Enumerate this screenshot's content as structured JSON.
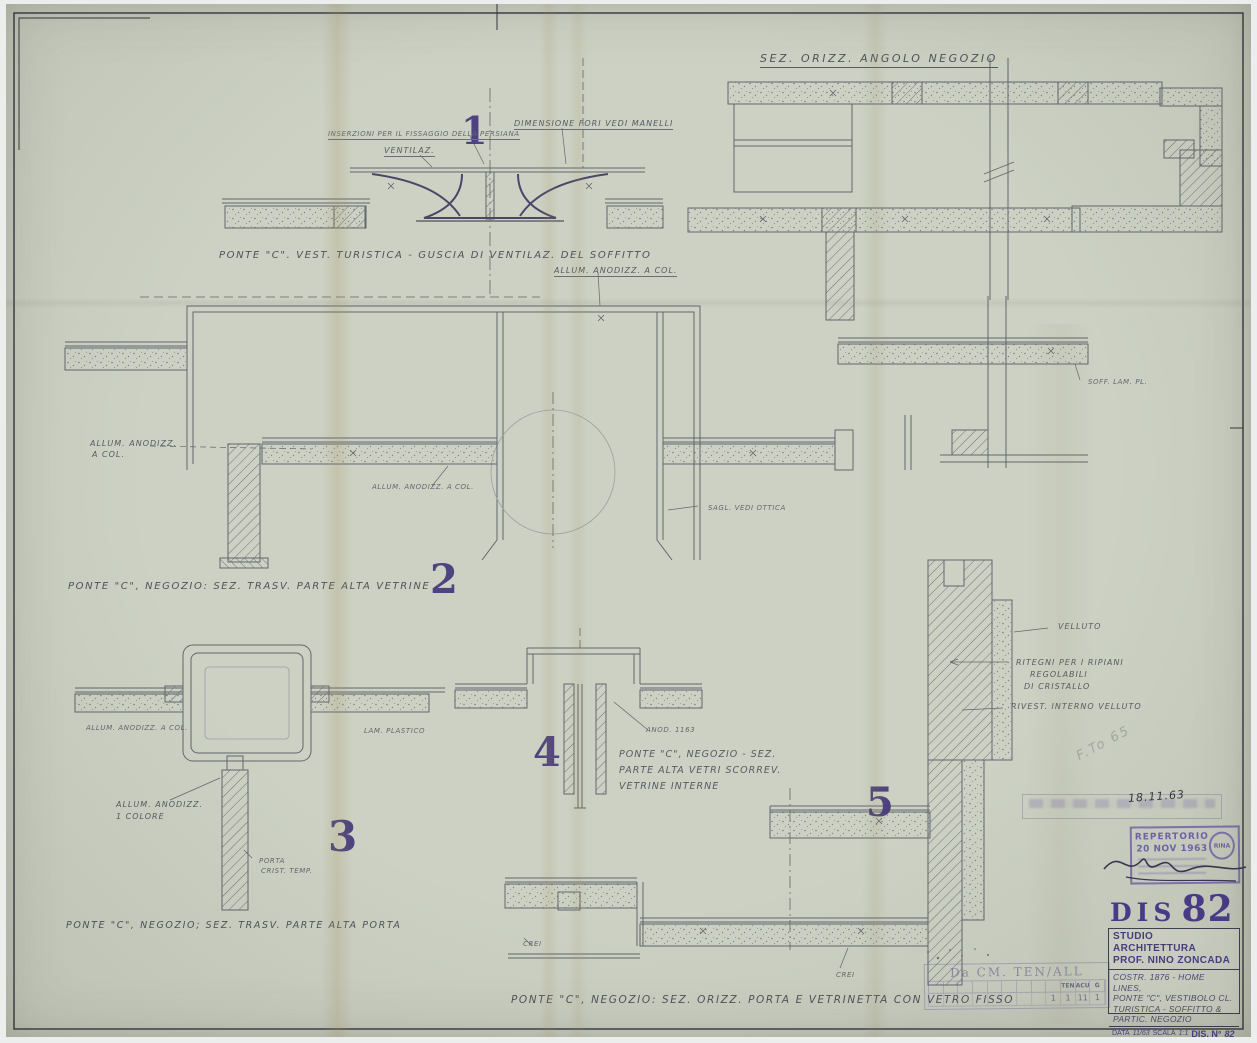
{
  "plan": {
    "title": "SEZ. ORIZZ. ANGOLO NEGOZIO"
  },
  "details": {
    "d1": {
      "number": "1",
      "label_fissaggio": "INSERZIONI PER IL FISSAGGIO DELLA PERSIANA",
      "label_ventilaz": "VENTILAZ.",
      "label_dimensione": "DIMENSIONE FORI VEDI MANELLI",
      "caption": "PONTE \"C\". VEST. TURISTICA -  GUSCIA DI VENTILAZ. DEL SOFFITTO"
    },
    "d2": {
      "number": "2",
      "label_top": "ALLUM. ANODIZZ. A COL.",
      "label_left_1": "ALLUM. ANODIZZ.",
      "label_left_2": "A COL.",
      "label_mid": "ALLUM. ANODIZZ. A COL.",
      "label_sagoma": "SAGL. VEDI OTTICA",
      "label_soffitto": "SOFF. LAM. PL.",
      "caption": "PONTE \"C\", NEGOZIO: SEZ. TRASV. PARTE ALTA VETRINE"
    },
    "d3": {
      "number": "3",
      "label_left": "ALLUM. ANODIZZ. A COL.",
      "label_lam": "LAM. PLASTICO",
      "label_anod_1": "ALLUM. ANODIZZ.",
      "label_anod_2": "1 COLORE",
      "label_porta_1": "PORTA",
      "label_porta_2": "CRIST. TEMP.",
      "caption": "PONTE \"C\", NEGOZIO; SEZ. TRASV. PARTE ALTA PORTA"
    },
    "d4": {
      "number": "4",
      "label_anod": "ANOD. 1163",
      "caption_1": "PONTE \"C\", NEGOZIO - SEZ.",
      "caption_2": "PARTE ALTA VETRI SCORREV.",
      "caption_3": "VETRINE INTERNE"
    },
    "d5": {
      "number": "5",
      "label_velluto": "VELLUTO",
      "label_ritegni_1": "RITEGNI PER I RIPIANI",
      "label_ritegni_2": "REGOLABILI",
      "label_ritegni_3": "DI CRISTALLO",
      "label_rivest": "RIVEST. INTERNO VELLUTO",
      "label_crei_a": "CREI",
      "label_crei_b": "CREI"
    },
    "bottom_caption": "PONTE \"C\", NEGOZIO: SEZ. ORIZZ. PORTA E VETRINETTA CON VETRO FISSO"
  },
  "title_block": {
    "dis_label": "DIS",
    "dis_number": "82",
    "studio_line1": "STUDIO ARCHITETTURA",
    "studio_line2": "PROF. NINO ZONCADA",
    "desc_line1": "COSTR. 1876 - HOME LINES,",
    "desc_line2": "PONTE \"C\", VESTIBOLO CL.",
    "desc_line3": "TURISTICA - SOFFITTO &",
    "desc_line4": "PARTIC. NEGOZIO",
    "data_label": "DATA",
    "data_value": "11/63",
    "scala_label": "SCALA",
    "scala_value": "1:1",
    "disno_label": "DIS. N°",
    "disno_value": "82"
  },
  "stamps": {
    "date_note": "18.11.63",
    "repertorio": "REPERTORIO",
    "rep_date": "20 NOV 1963",
    "rina": "RINA",
    "tenall_title": "Da CM. TEN/ALL",
    "ten": "TEN",
    "acu": "ACU",
    "g": "G",
    "n1": "1",
    "n2": "1",
    "n3": "11",
    "n4": "1",
    "fto_note": "F.To 65"
  }
}
